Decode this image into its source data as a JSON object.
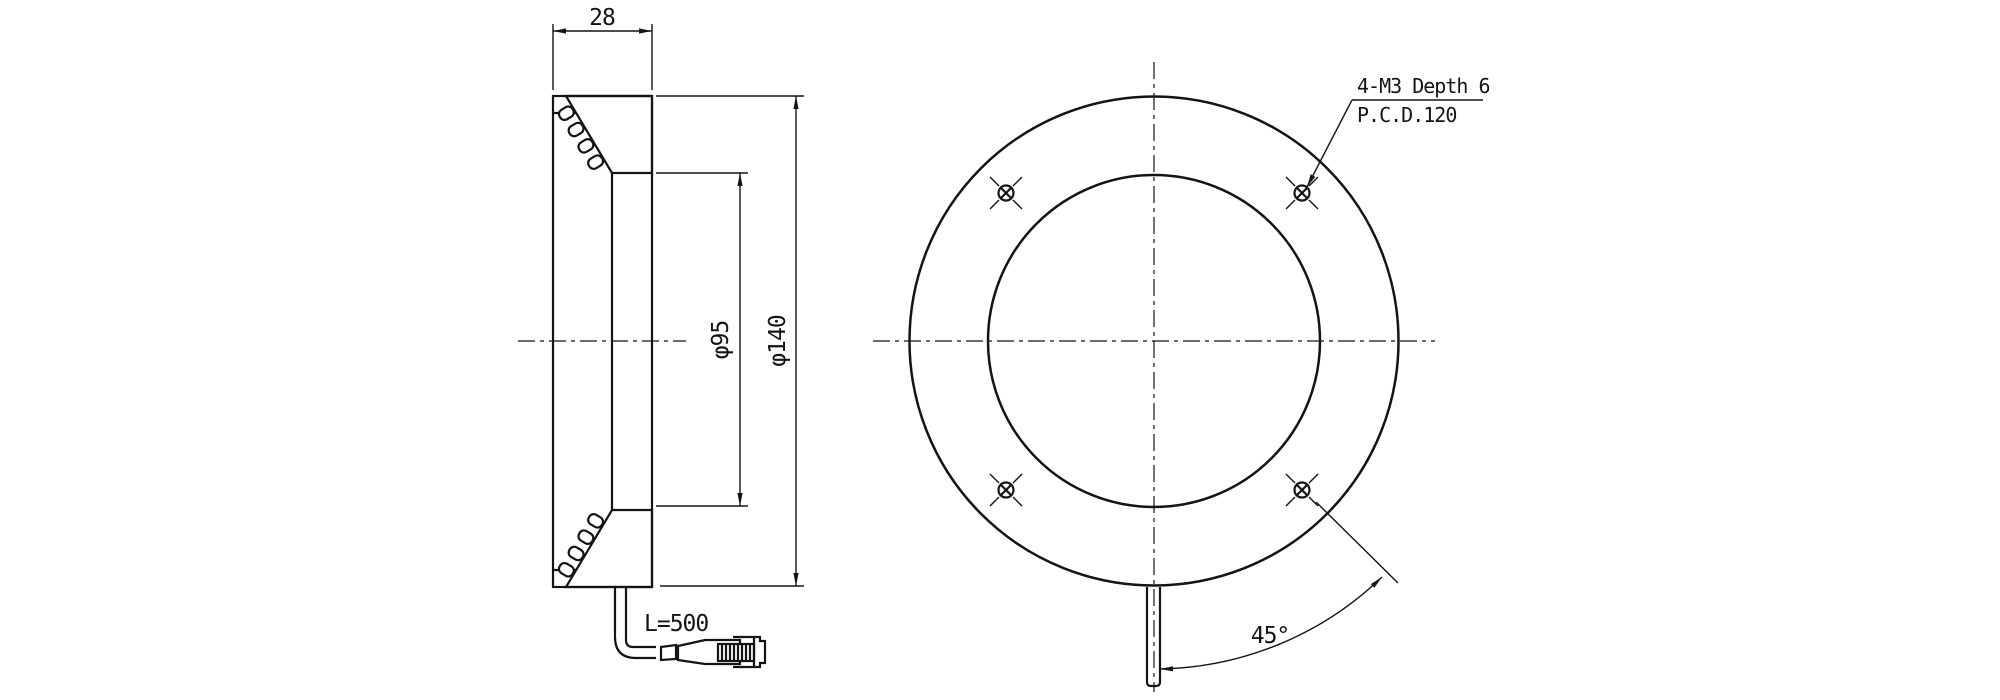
{
  "colors": {
    "line": "#141414",
    "background": "#ffffff"
  },
  "side_view": {
    "width_dim": "28",
    "inner_diameter_dim": "φ95",
    "outer_diameter_dim": "φ140",
    "cable_length_label": "L=500"
  },
  "front_view": {
    "mounting_note_line1": "4-M3 Depth 6",
    "mounting_note_line2": "P.C.D.120",
    "angle_dim": "45°"
  }
}
